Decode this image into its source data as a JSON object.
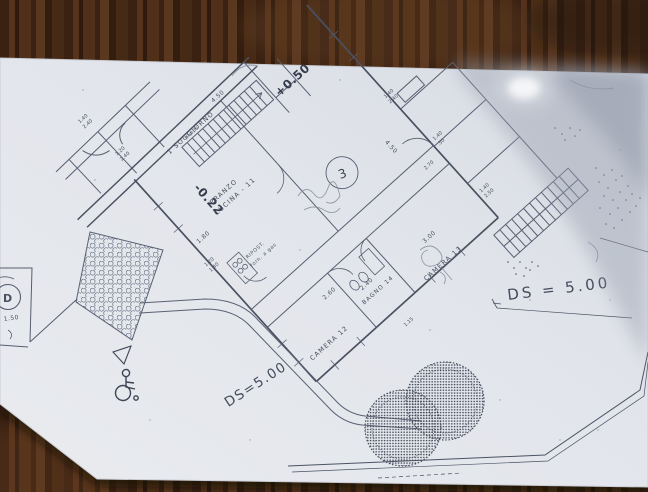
{
  "plan": {
    "unit_number": "3",
    "levels": {
      "upper": "+0.50",
      "lower": "-0.22"
    },
    "rooms": {
      "soggiorno": "1 SOGGIORNO",
      "pranzo": "PRANZO",
      "cucina": "CUCINA - 11",
      "camera12": "CAMERA 12",
      "bagno": "BAGNO 14",
      "camera13": "CAMERA 13",
      "ripostiglio": "RIPOST.",
      "forno": "forn. a gas"
    },
    "annotations": {
      "ds_left": "DS=5.00",
      "ds_right": "DS = 5.00",
      "parking": "D",
      "parking_dim": "1.50"
    },
    "dims": [
      "4.50",
      "1.40",
      "2.40",
      "1.20",
      "2.40",
      "1.40",
      "2.40",
      "4.50",
      "1.40",
      ".50",
      "3.00",
      "2.40",
      "2.60",
      "1.15",
      "1.80",
      "1.20",
      "1.40",
      "1.40",
      "2.50",
      "2.70",
      "10x0,30"
    ]
  }
}
